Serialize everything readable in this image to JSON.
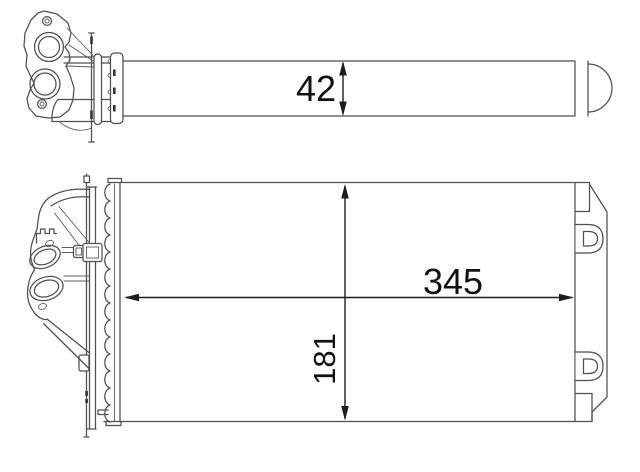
{
  "diagram": {
    "type": "technical-drawing",
    "subject": "automotive heater core / heat exchanger shown in two orthographic line-art views",
    "background_color": "#ffffff",
    "part_line_color": "#4f4f4f",
    "dimension_color": "#1c1c1c",
    "views": [
      {
        "id": "side-view",
        "description": "upper view: thin side profile with twin-port inlet flange on the left and rounded end cap on the right"
      },
      {
        "id": "front-view",
        "description": "lower view: front face of core with perspective pipe flange on the left and side tank with two mounting brackets on the right"
      }
    ],
    "dimensions": [
      {
        "id": "thickness",
        "label": "42",
        "orientation": "vertical",
        "view": "side-view"
      },
      {
        "id": "width",
        "label": "345",
        "orientation": "horizontal",
        "view": "front-view"
      },
      {
        "id": "height",
        "label": "181",
        "orientation": "vertical-rotated",
        "view": "front-view"
      }
    ]
  }
}
